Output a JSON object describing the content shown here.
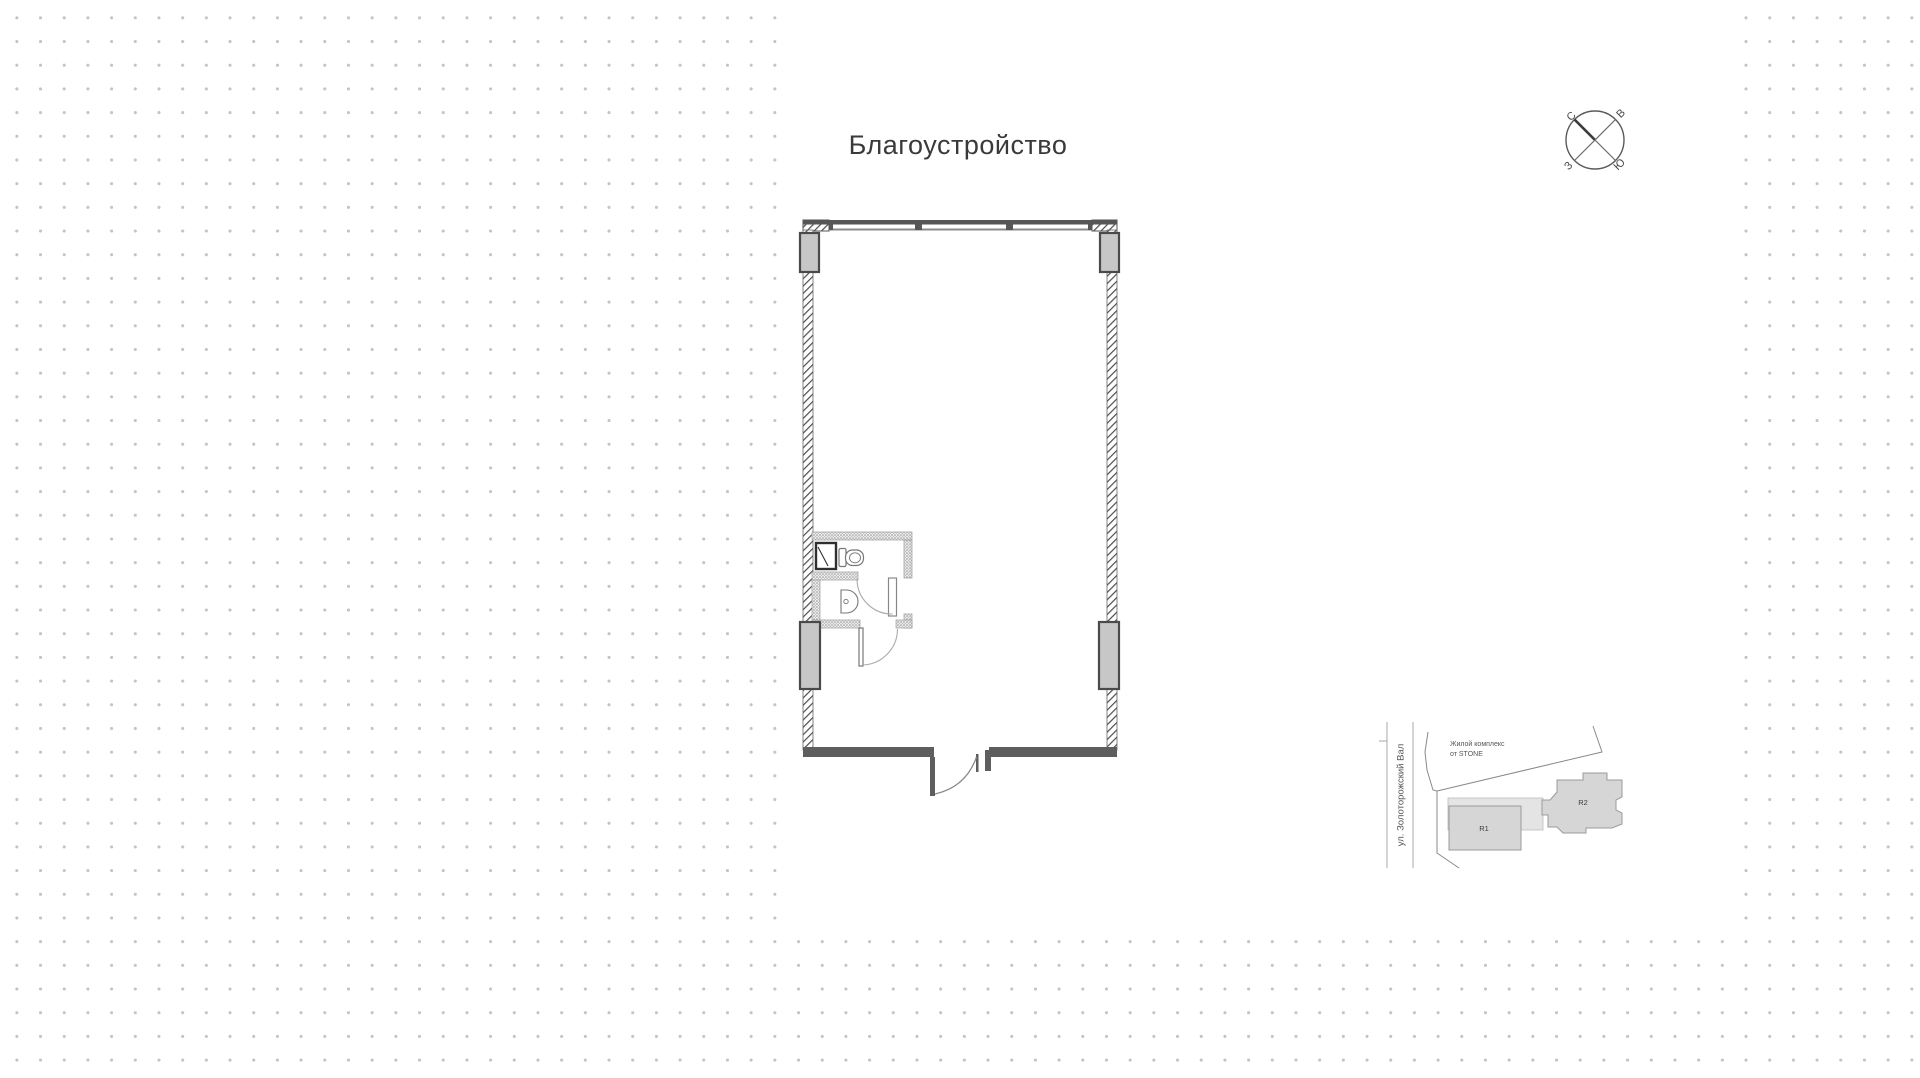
{
  "title": "Благоустройство",
  "compass": {
    "north_label": "С",
    "east_label": "В",
    "south_label": "Ю",
    "west_label": "З"
  },
  "site_map": {
    "street_label": "ул. Золоторожский Вал",
    "complex_label_line1": "Жилой комплекс",
    "complex_label_line2": "от STONE",
    "building_r1_label": "R1",
    "building_r2_label": "R2"
  },
  "colors": {
    "background_dot": "#c4c4c4",
    "card": "#ffffff",
    "wall_dark": "#565656",
    "wall_hatch": "#4d4d4d",
    "column_fill": "#c7c7c7",
    "column_stroke": "#4a4a4a",
    "bathroom_wall_dot": "#949494",
    "building_fill": "#d6d6d6",
    "building_stroke": "#9b9b9b",
    "title_text": "#3a3a3a"
  }
}
